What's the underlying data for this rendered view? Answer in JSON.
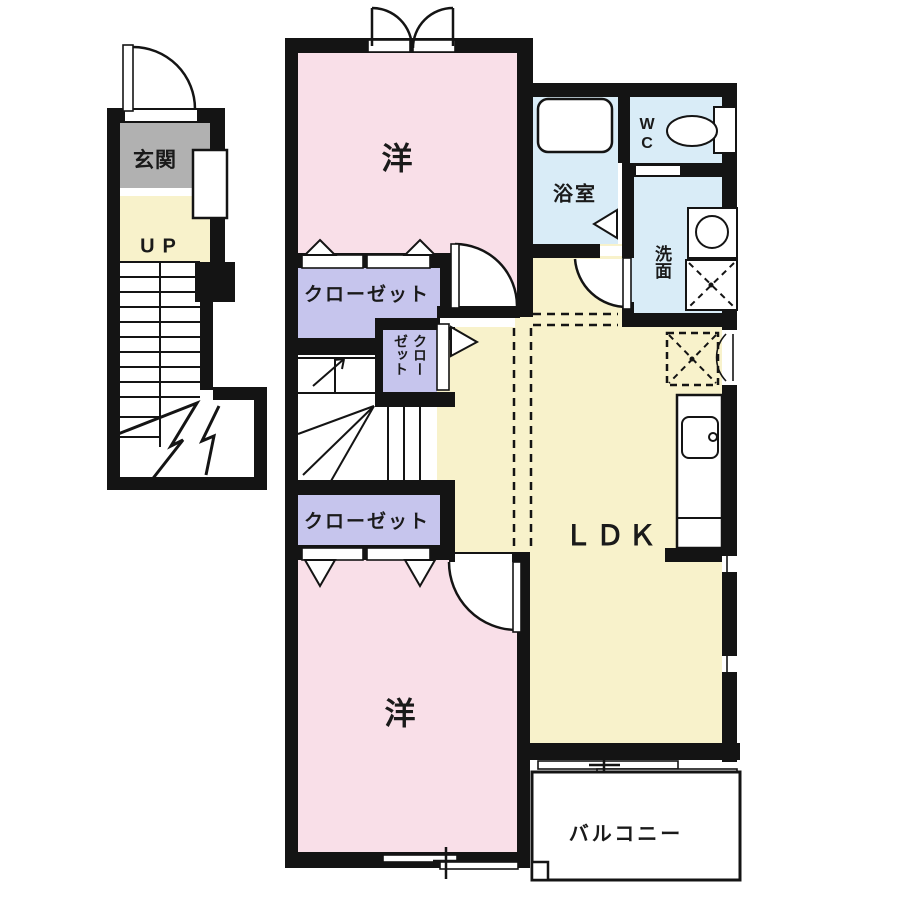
{
  "plan": {
    "type": "apartment-floor-plan",
    "labels": {
      "genkan": "玄関",
      "stairs_up": "UP",
      "western_room_top": "洋",
      "closet_top": "クローゼット",
      "closet_small": "クローゼット",
      "bathroom": "浴室",
      "toilet": "WC",
      "washroom": "洗面",
      "ldk": "ＬＤＫ",
      "closet_bottom": "クローゼット",
      "western_room_bottom": "洋",
      "balcony": "バルコニー"
    },
    "colors": {
      "room_pink": "#f9dfe8",
      "floor_yellow": "#f8f2cb",
      "closet_lavender": "#c6c5ed",
      "wet_area_blue": "#d9ecf7",
      "entry_gray": "#b1b1b1",
      "wall_black": "#141414",
      "background": "#ffffff"
    }
  }
}
